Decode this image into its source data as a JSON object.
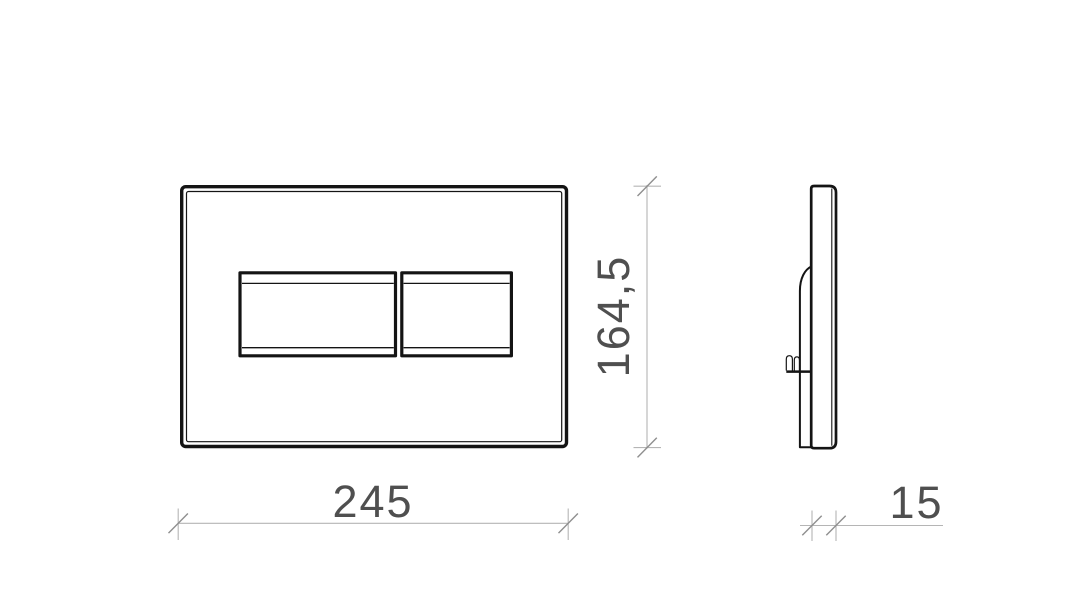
{
  "drawing": {
    "type": "technical-orthographic-drawing",
    "subject": "wall-mounted flush plate, front view and side view",
    "dimensions": {
      "width": {
        "label": "245",
        "value": 245
      },
      "height": {
        "label": "164,5",
        "value": 164.5
      },
      "depth": {
        "label": "15",
        "value": 15
      }
    },
    "colors": {
      "background": "#ffffff",
      "outline": "#141414",
      "dimension_line": "#b5b5b5",
      "dimension_tick": "#8f8f8f",
      "dimension_text": "#4f4f4f"
    }
  }
}
